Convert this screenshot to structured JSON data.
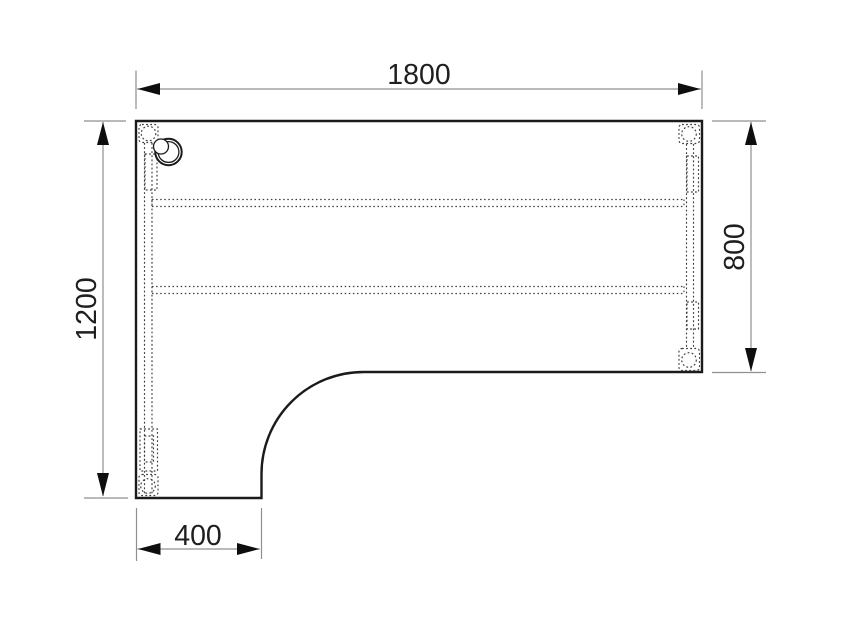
{
  "dimensions": {
    "top": {
      "value": "1800"
    },
    "left": {
      "value": "1200"
    },
    "right": {
      "value": "800"
    },
    "bottom": {
      "value": "400"
    }
  },
  "colors": {
    "background": "#ffffff",
    "surface": "#ffffff",
    "outline": "#1b1b1b",
    "detail": "#3d3d3d",
    "dimension": "#8f8f8f",
    "arrow": "#0e0e0e",
    "text": "#1f1f1f"
  }
}
